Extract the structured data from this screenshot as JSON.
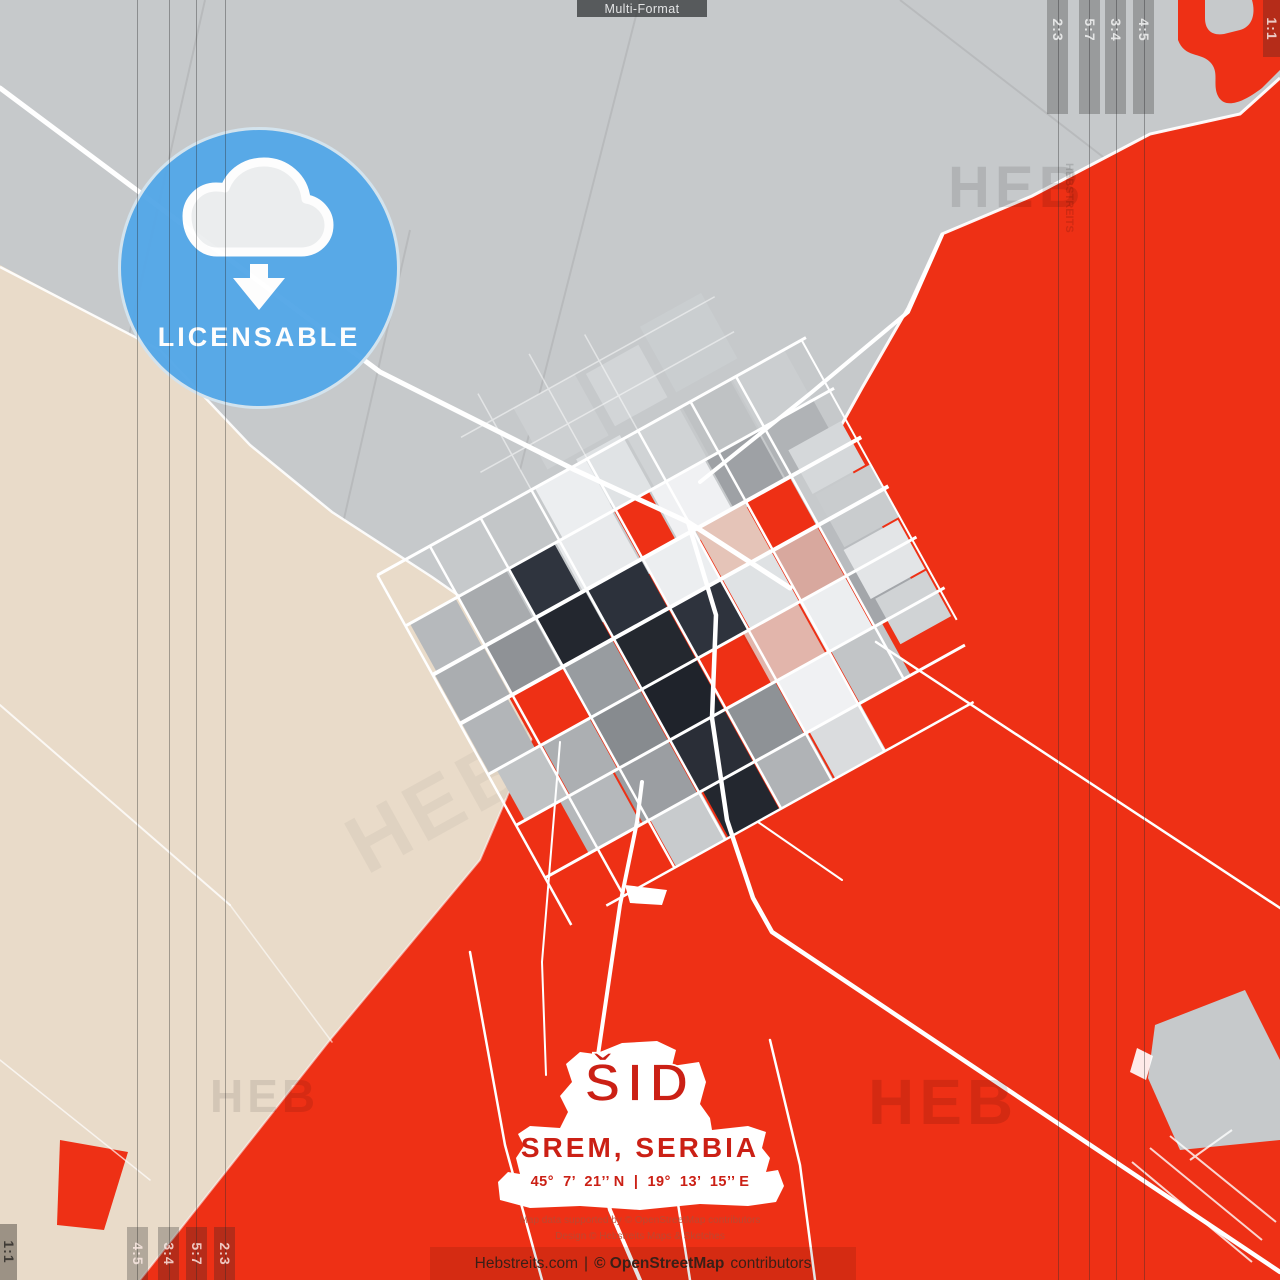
{
  "top_bar": {
    "label": "Multi-Format"
  },
  "badge": {
    "label": "LICENSABLE",
    "icon": "cloud-download-icon"
  },
  "format_marks": {
    "top_right": [
      "2:3",
      "5:7",
      "3:4",
      "4:5"
    ],
    "right_edge": "1:1",
    "bottom_left": [
      "4:5",
      "3:4",
      "5:7",
      "2:3"
    ],
    "left_edge": "1:1"
  },
  "city_label": {
    "name": "ŠID",
    "region": "SREM, SERBIA",
    "coordinates": "45°  7’  21’’ N  |  19°  13’  15’’ E"
  },
  "credits": {
    "line1": "Map data supported by © OpenStreetMap contributors",
    "line2": "Design © Hebstreits Maps & Sketches"
  },
  "footer": {
    "site": "Hebstreits.com",
    "separator": "|",
    "osm": "© OpenStreetMap",
    "suffix": "contributors"
  },
  "watermark": {
    "text": "HEB",
    "small": "HEBSTREITS"
  },
  "colors": {
    "gray_land": "#c6c9cb",
    "beige_land": "#e9dbc9",
    "red_land": "#ee3015",
    "badge_blue": "#55a8e8",
    "road_white": "#ffffff",
    "label_red": "#cb2015",
    "footer_text": "#3a1f17",
    "credit_text": "#b84a33"
  }
}
